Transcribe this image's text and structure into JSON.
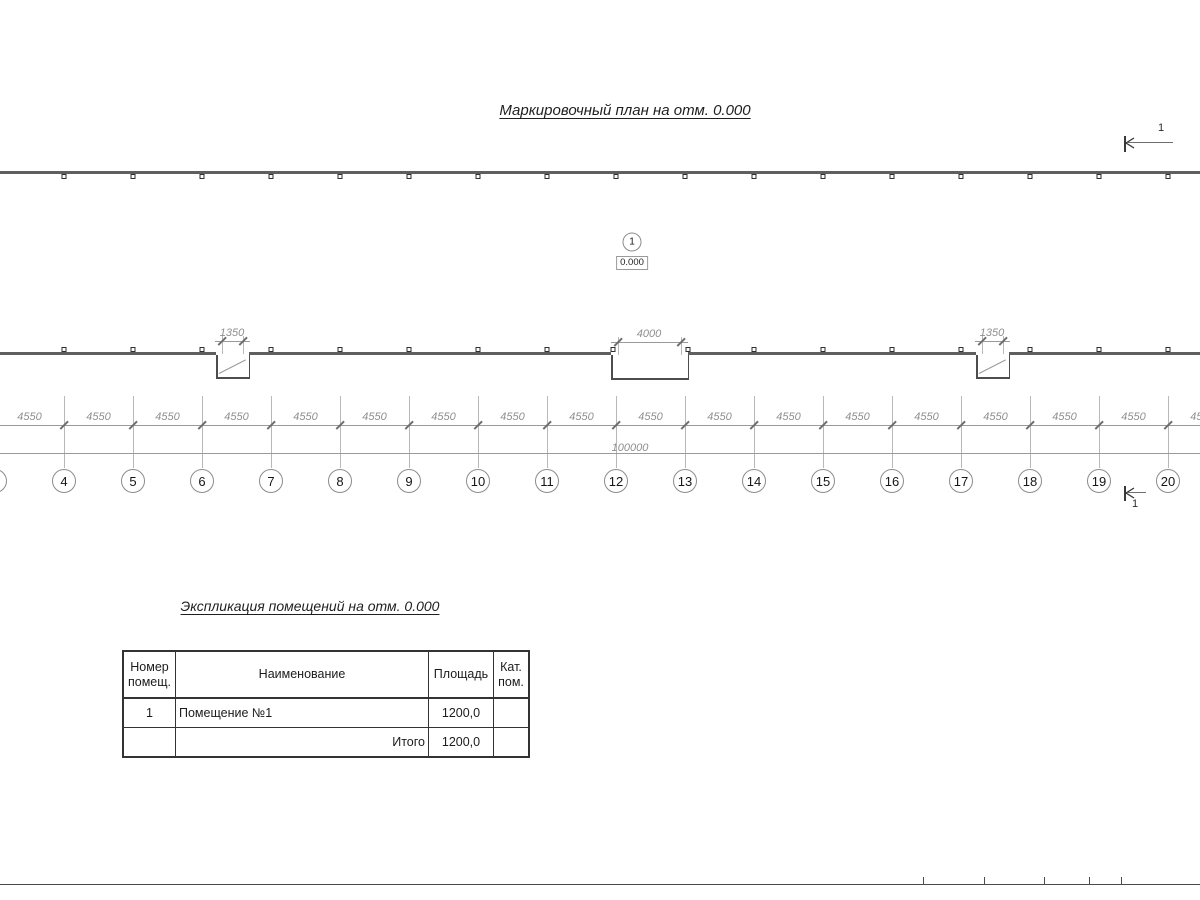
{
  "colors": {
    "ink": "#2f2f2f",
    "wall_gray": "#5f5f5f",
    "dim_gray": "#8f8f8f",
    "light_line": "#b8b8b8"
  },
  "plan": {
    "title": "Маркировочный план на отм. 0.000",
    "room_tag": {
      "number": "1",
      "elevation": "0.000"
    },
    "axes": {
      "numbers": [
        "4",
        "5",
        "6",
        "7",
        "8",
        "9",
        "10",
        "11",
        "12",
        "13",
        "14",
        "15",
        "16",
        "17",
        "18",
        "19",
        "20"
      ]
    },
    "dimensions": {
      "bay_label": "4550",
      "bay_count": 18,
      "total_label": "100000",
      "openings": [
        {
          "label": "1350"
        },
        {
          "label": "4000"
        },
        {
          "label": "1350"
        }
      ]
    },
    "section_marks": {
      "top_label": "1",
      "bottom_label": "1"
    }
  },
  "explication": {
    "title": "Экспликация помещений на отм. 0.000",
    "table": {
      "headers": [
        "Номер помещ.",
        "Наименование",
        "Площадь",
        "Кат. пом."
      ],
      "rows": [
        {
          "number": "1",
          "name": "Помещение №1",
          "area": "1200,0",
          "cat": ""
        },
        {
          "number": "",
          "name": "Итого",
          "area": "1200,0",
          "cat": ""
        }
      ]
    }
  }
}
